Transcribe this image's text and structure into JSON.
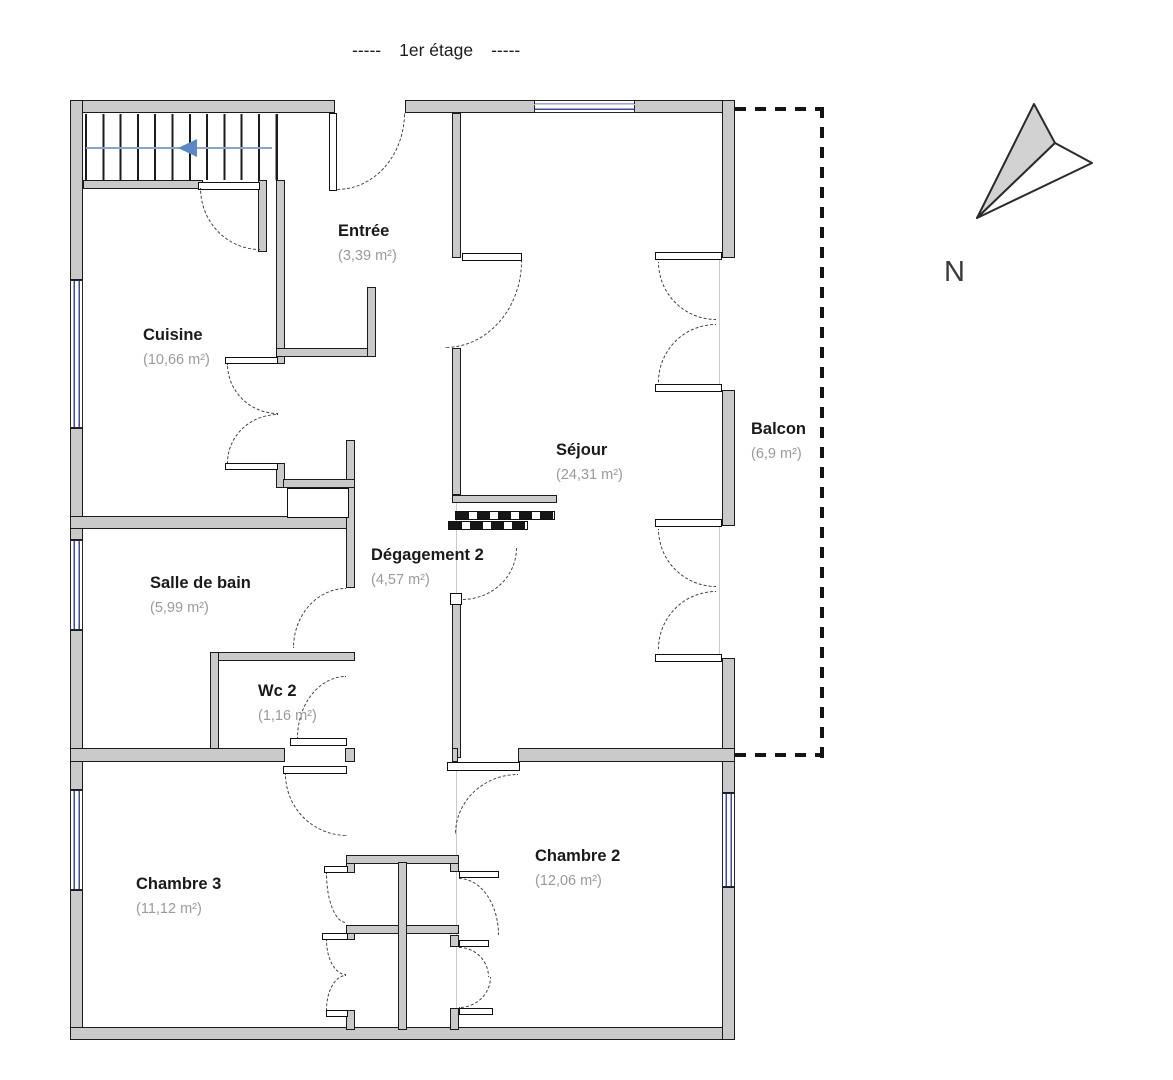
{
  "title": {
    "prefix": "-----",
    "text": "1er étage",
    "suffix": "-----"
  },
  "compass": {
    "label": "N"
  },
  "rooms": [
    {
      "id": "entree",
      "name": "Entrée",
      "area": "(3,39 m²)"
    },
    {
      "id": "cuisine",
      "name": "Cuisine",
      "area": "(10,66 m²)"
    },
    {
      "id": "sejour",
      "name": "Séjour",
      "area": "(24,31 m²)"
    },
    {
      "id": "balcon",
      "name": "Balcon",
      "area": "(6,9 m²)"
    },
    {
      "id": "salle-de-bain",
      "name": "Salle de bain",
      "area": "(5,99 m²)"
    },
    {
      "id": "degagement-2",
      "name": "Dégagement 2",
      "area": "(4,57 m²)"
    },
    {
      "id": "wc-2",
      "name": "Wc 2",
      "area": "(1,16 m²)"
    },
    {
      "id": "chambre-3",
      "name": "Chambre 3",
      "area": "(11,12 m²)"
    },
    {
      "id": "chambre-2",
      "name": "Chambre 2",
      "area": "(12,06 m²)"
    }
  ],
  "colors": {
    "wall_fill": "#cacaca",
    "wall_outline": "#1b1b1b",
    "window_glass_blue": "#3f4aa0",
    "door_arc": "#3c3c3c",
    "stair_arrow_blue": "#5d88c8",
    "balcony_dash": "#141414",
    "room_name_text": "#1a1a1a",
    "room_area_text": "#9a9a9e"
  }
}
